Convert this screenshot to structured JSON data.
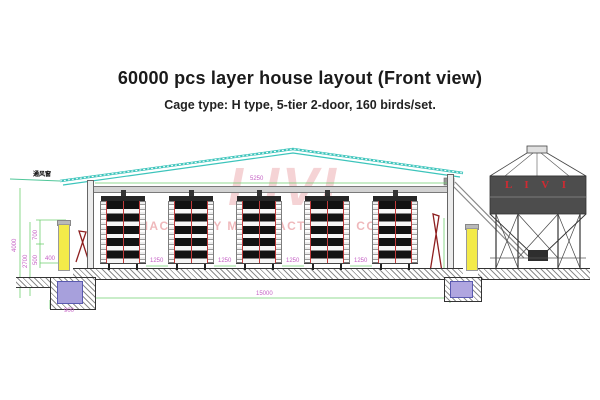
{
  "header": {
    "title": "60000 pcs layer house layout (Front view)",
    "subtitle": "Cage type: H type, 5-tier 2-door, 160 birds/set."
  },
  "watermark": {
    "logo": "LIVI",
    "company": "MACHINERY MANUFACTURING CO.,LTD"
  },
  "diagram": {
    "vent_label": "通风窗",
    "silo_brand": "L I V I",
    "dimensions": {
      "overall_width": "15000",
      "ceiling_span": "5250",
      "rack_gap": "1250",
      "total_height": "4000",
      "wall_height": "2700",
      "fan_top": "700",
      "fan_height": "500",
      "pit_offset": "400",
      "pit_width": "900"
    }
  }
}
